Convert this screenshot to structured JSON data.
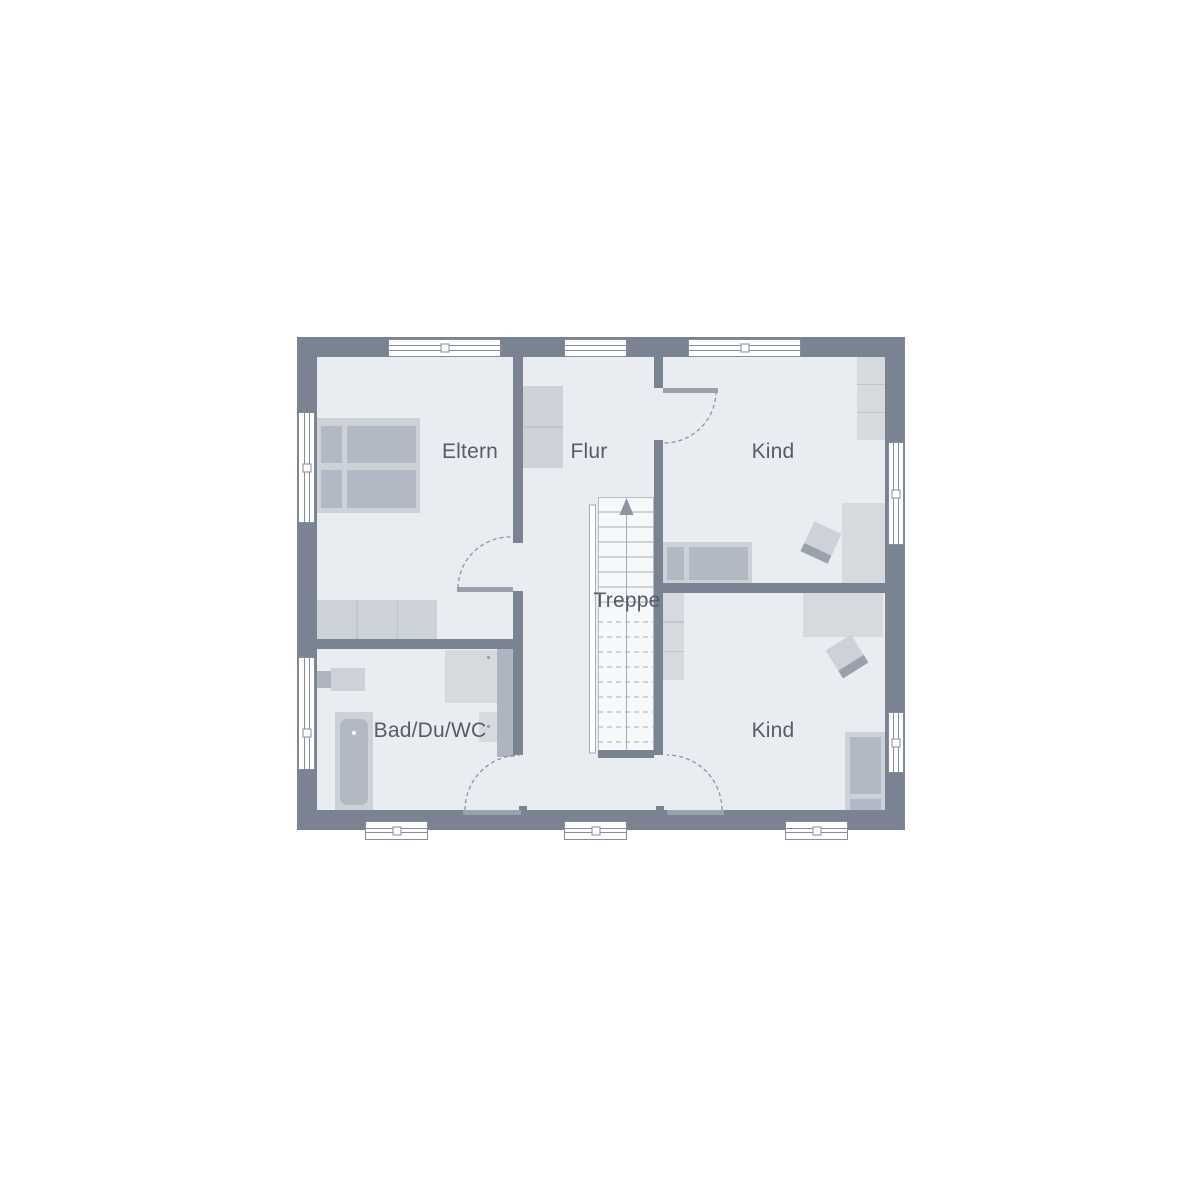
{
  "canvas": {
    "width": 1200,
    "height": 1200
  },
  "rooms": [
    {
      "id": "eltern",
      "label": "Eltern"
    },
    {
      "id": "flur",
      "label": "Flur"
    },
    {
      "id": "kind-top",
      "label": "Kind"
    },
    {
      "id": "treppe",
      "label": "Treppe"
    },
    {
      "id": "bad-du-wc",
      "label": "Bad/Du/WC"
    },
    {
      "id": "kind-bottom",
      "label": "Kind"
    }
  ],
  "icons": {
    "stairs_direction": "up-arrow"
  },
  "colors": {
    "background": "#ffffff",
    "wall": "#7a8391",
    "floor": "#e9ecf1",
    "furniture_light": "#cdd2d9",
    "furniture_mid": "#b3b9c4",
    "furniture_pale": "#d6dade",
    "fixture": "#aeb5c0",
    "seg_gap": "#bfc4cd",
    "stair_fill": "#f7f8fa",
    "stair_line": "#a7aeb8",
    "door": "#99a1ad",
    "arc": "#8d95a2",
    "window_frame": "#848d9a",
    "label_text": "#565c68"
  }
}
